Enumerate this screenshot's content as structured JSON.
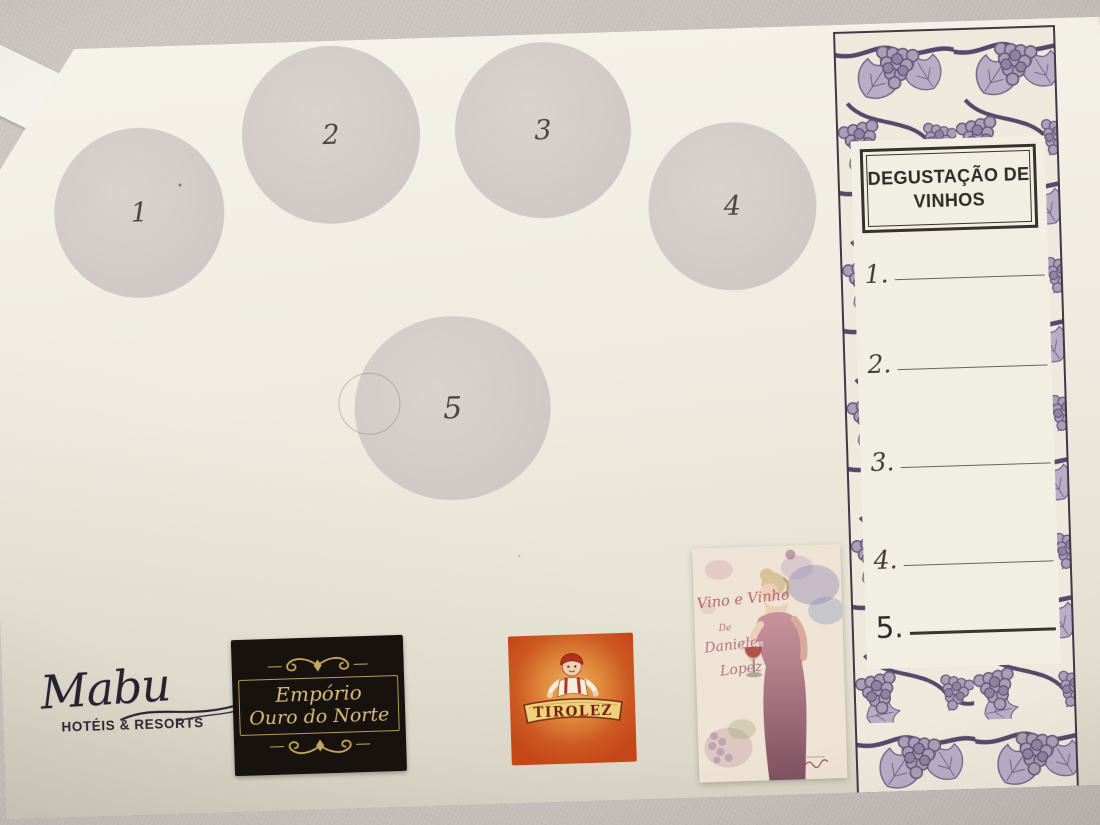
{
  "placemat": {
    "glass_circles": [
      {
        "label": "1"
      },
      {
        "label": "2"
      },
      {
        "label": "3"
      },
      {
        "label": "4"
      },
      {
        "label": "5"
      }
    ],
    "tasting_panel": {
      "title_line1": "DEGUSTAÇÃO DE",
      "title_line2": "VINHOS",
      "note_lines": [
        {
          "number": "1."
        },
        {
          "number": "2."
        },
        {
          "number": "3."
        },
        {
          "number": "4."
        },
        {
          "number": "5."
        }
      ]
    },
    "sponsors": {
      "mabu": {
        "name": "Mabu",
        "tagline": "HOTÉIS & RESORTS"
      },
      "emporio": {
        "line1": "Empório",
        "line2": "Ouro do Norte"
      },
      "tirolez": {
        "name": "TIROLEZ"
      },
      "vinho_poster": {
        "title": "Vino e Vinho",
        "byline": "De",
        "author_first": "Daniele",
        "author_last": "Lopez"
      }
    }
  },
  "colors": {
    "table_gray": "#c8c2bc",
    "mat_cream": "#efebe0",
    "circle_gray": "#d2cbc8",
    "ink_dark": "#37322c",
    "grape_purple": "#6e6488",
    "grape_fill": "#a99fb6",
    "emporio_black": "#17120e",
    "emporio_gold": "#cfa75e",
    "tirolez_orange": "#c4471a",
    "banner_gold": "#ecd27c",
    "wine_red": "#a23a32",
    "rose_text": "#b4636d"
  }
}
